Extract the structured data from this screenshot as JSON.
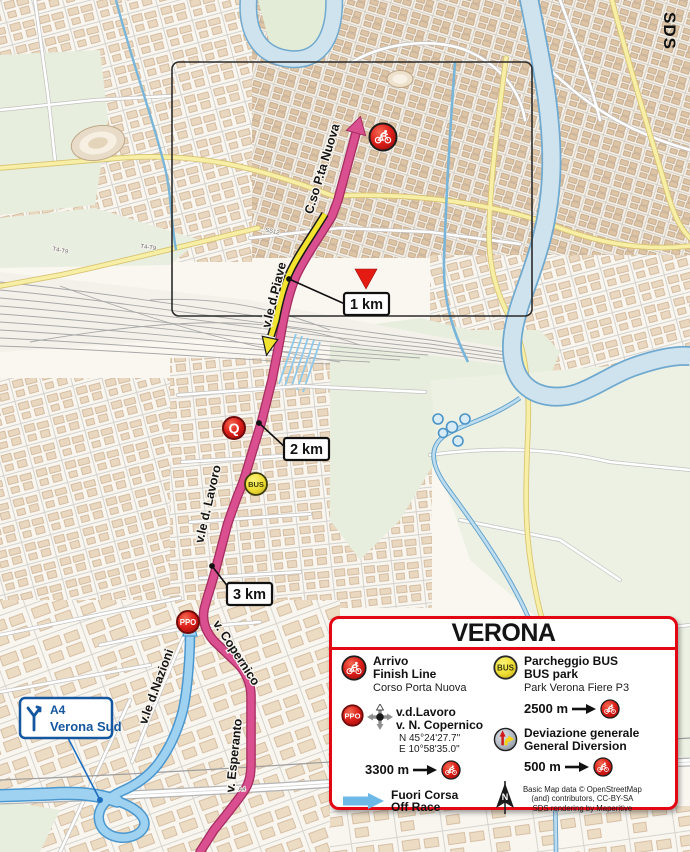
{
  "watermark": "SDS",
  "streets": {
    "corso": "C.so P.ta Nuova",
    "piave": "v.le d.Piave",
    "lavoro": "v.le d. Lavoro",
    "copernico": "v. Copernico",
    "nazioni": "v.le d.Nazioni",
    "esperanto": "v. Esperanto"
  },
  "roads": {
    "ss12": "SS12",
    "a4": "A4",
    "t4t9": "T4-T9"
  },
  "markers": {
    "km1": "1 km",
    "km2": "2 km",
    "km3": "3 km",
    "q": "Q",
    "bus": "BUS",
    "ppo": "PPO"
  },
  "a4_sign": {
    "road": "A4",
    "city": "Verona Sud"
  },
  "legend": {
    "title": "VERONA",
    "finish": {
      "line1": "Arrivo",
      "line2": "Finish Line",
      "street": "Corso Porta Nuova"
    },
    "ppo": {
      "badge": "PPO",
      "line1": "v.d.Lavoro",
      "line2": "v. N. Copernico",
      "coord1": "N 45°24'27.7\"",
      "coord2": "E 10°58'35.0\"",
      "distance": "3300 m"
    },
    "offrace": {
      "line1": "Fuori Corsa",
      "line2": "Off Race"
    },
    "bus": {
      "badge": "BUS",
      "line1": "Parcheggio BUS",
      "line2": "BUS park",
      "subtitle": "Park Verona Fiere P3",
      "distance": "2500 m"
    },
    "diversion": {
      "line1": "Deviazione generale",
      "line2": "General Diversion",
      "distance": "500 m"
    },
    "north_label": "N",
    "credits": [
      "Basic Map data © OpenStreetMap",
      "(and) contributors, CC-BY-SA",
      "SDS rendering by Maperitive"
    ]
  },
  "colors": {
    "route_pink": "#d94f8f",
    "route_pink_edge": "#a62d61",
    "diversion_yellow": "#f2e32f",
    "offrace_blue": "#9fd2f1",
    "offrace_blue_edge": "#4a97cf",
    "legend_red": "#e30613",
    "sign_blue": "#1456a0",
    "river_blue": "#cfe3ee",
    "road_yellow": "#f7efa6"
  }
}
